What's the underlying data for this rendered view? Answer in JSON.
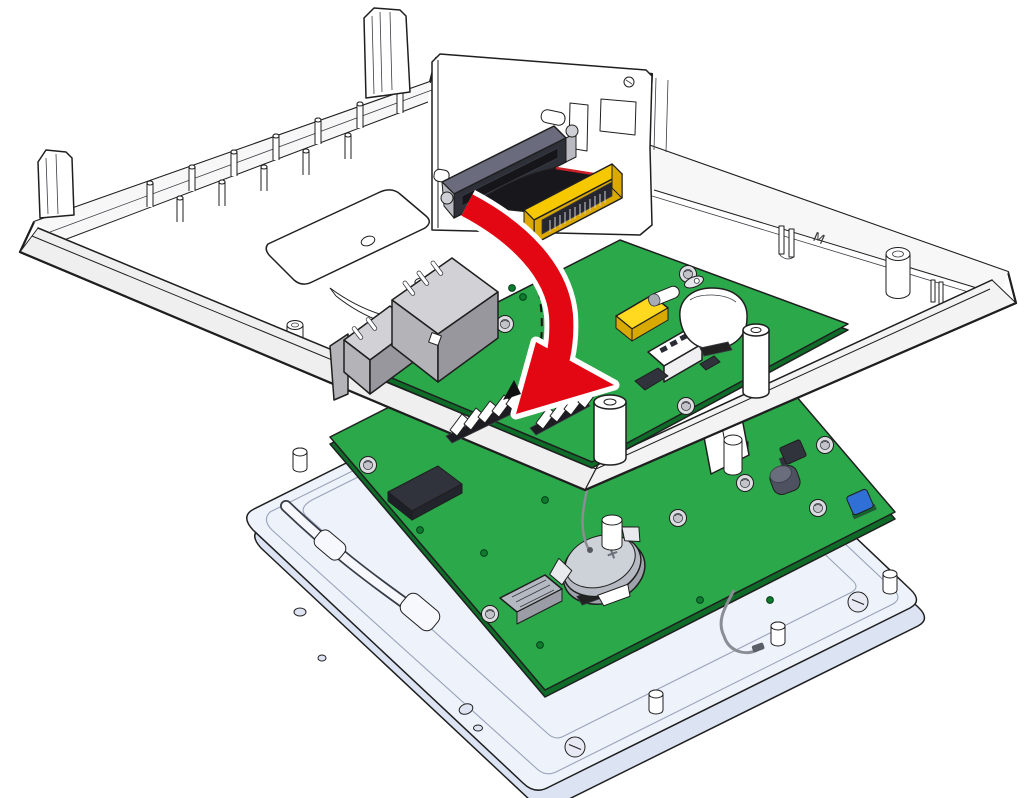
{
  "illustration": {
    "type": "exploded-assembly-diagram",
    "mold_mark": "M"
  },
  "colors": {
    "outline": "#1f1f1f",
    "housing_white": "#ffffff",
    "housing_wall": "#f7f7f7",
    "housing_band_left": "#efefef",
    "housing_band_right": "#f3f3f3",
    "pcb_green": "#2aa84a",
    "pcb_edge_green": "#0e6b28",
    "via_green": "#0d7a2e",
    "frame_white": "#eef2fb",
    "frame_side": "#dce4f4",
    "socket_gray_top": "#6a6c7e",
    "socket_gray_front": "#2e3039",
    "socket_slot": "#15151a",
    "edge_connector_yellow": "#f6c800",
    "edge_connector_side": "#dca900",
    "edge_connector_recess": "#26262e",
    "chip_yellow": "#ffd91f",
    "chip_yellow_side": "#d8a900",
    "jack_gray_top": "#d2d2d6",
    "jack_gray_left": "#b3b3b8",
    "jack_gray_right": "#97979d",
    "battery_gray": "#b5b9c1",
    "battery_top": "#cdd1d8",
    "black_component": "#30323c",
    "blue_component": "#2f6fd6",
    "ribbon_black": "#18181c",
    "ribbon_stripe_red": "#cc2128",
    "arrow_red": "#e30613",
    "arrow_casing": "#ffffff",
    "wire_gray": "#8a8d93",
    "white_component": "#ffffff"
  }
}
